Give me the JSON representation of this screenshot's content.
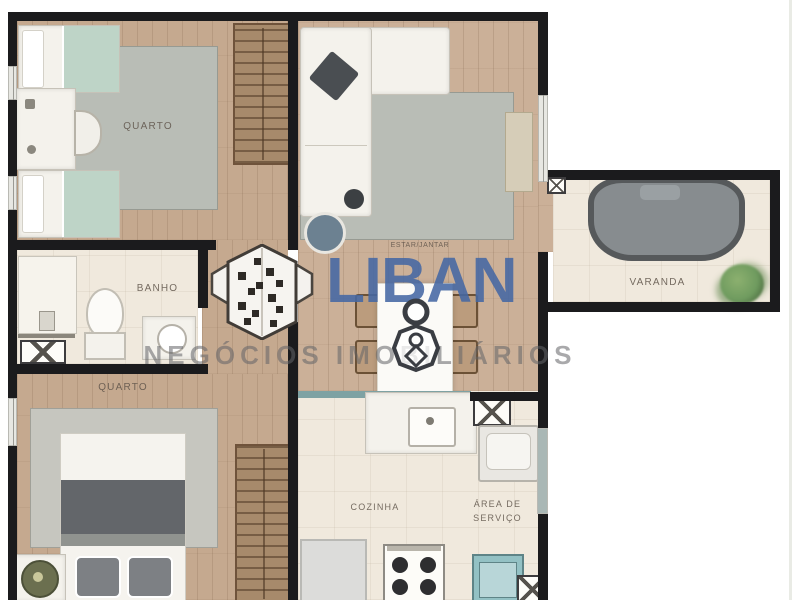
{
  "watermark": {
    "brand": "LIBAN",
    "tagline": "NEGÓCIOS IMOBILIÁRIOS"
  },
  "rooms": {
    "bedroom1": {
      "label": "QUARTO"
    },
    "bathroom": {
      "label": "BANHO"
    },
    "bedroom2": {
      "label": "QUARTO"
    },
    "living": {
      "label": "ESTAR/JANTAR"
    },
    "hall": {
      "label": "CIRC."
    },
    "kitchen": {
      "label": "COZINHA"
    },
    "service": {
      "line1": "ÁREA DE",
      "line2": "SERVIÇO"
    },
    "balcony": {
      "label": "VARANDA"
    }
  },
  "colors": {
    "wood": "#c5a98f",
    "wood_light": "#cbb098",
    "floor_cream": "#f0e9dd",
    "wall": "#1b1b1d",
    "rug_gray": "#b9bdb6",
    "mint": "#bed4c7",
    "blanket_gray": "#63666a",
    "teal_appliance": "#93c1c4",
    "counter_teal": "#7ea2a3",
    "wardrobe": "#a78a6b",
    "wardrobe_slat": "#6f533b",
    "daybed_frame": "#56595b",
    "daybed_cushion": "#878c8f",
    "plant_green": "#6f9b5f",
    "window_gray": "#a9b7b5",
    "brand": "#4568a4",
    "tagline": "#636468",
    "label": "#5f544a"
  }
}
